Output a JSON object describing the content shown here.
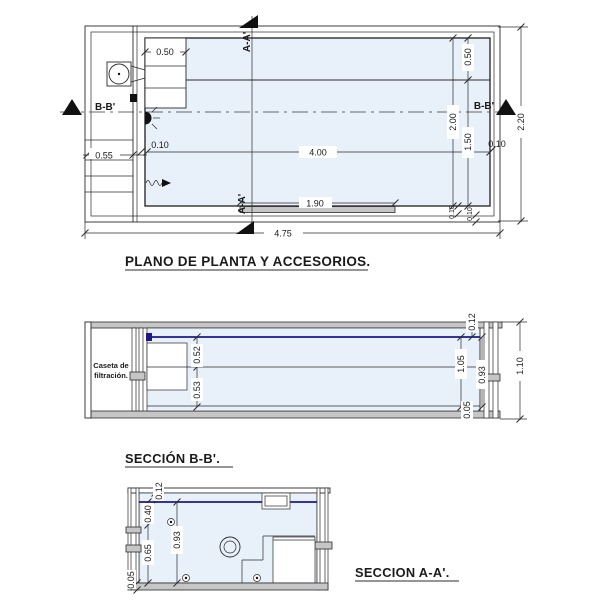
{
  "plan": {
    "title": "PLANO DE PLANTA Y ACCESORIOS.",
    "markers": {
      "bb_left": "B-B'",
      "bb_right": "B-B'",
      "aa_top": "A-A'",
      "aa_bottom": "A-A'"
    },
    "dims": {
      "stair_width": "0.50",
      "caseta_width": "0.55",
      "wall_left": "0.10",
      "inner_length": "4.00",
      "bench_length": "1.90",
      "total_length": "4.75",
      "bench_width": "0.50",
      "inner_width": "2.00",
      "main_width": "1.50",
      "wall_right": "0.10",
      "total_width": "2.20",
      "wall_bottom_a": "0.10",
      "wall_bottom_b": "0.10"
    }
  },
  "section_bb": {
    "title": "SECCIÓN B-B'.",
    "caseta_label": [
      "Caseta de",
      "filtración."
    ],
    "dims": {
      "step_upper": "0.52",
      "step_lower": "0.53",
      "freeboard": "0.12",
      "water_depth": "1.05",
      "inner_depth": "0.93",
      "floor_layer": "0.05",
      "total_depth": "1.10"
    }
  },
  "section_aa": {
    "title": "SECCION A-A'.",
    "dims": {
      "freeboard": "0.12",
      "upper_step": "0.40",
      "inner_depth": "0.93",
      "lower_step": "0.65",
      "floor_layer": "0.05"
    }
  },
  "colors": {
    "water_fill": "#e8f0fa",
    "water_line": "#1a1a8c",
    "wall_gray": "#c6c6c6",
    "line": "#2b2b2b"
  }
}
